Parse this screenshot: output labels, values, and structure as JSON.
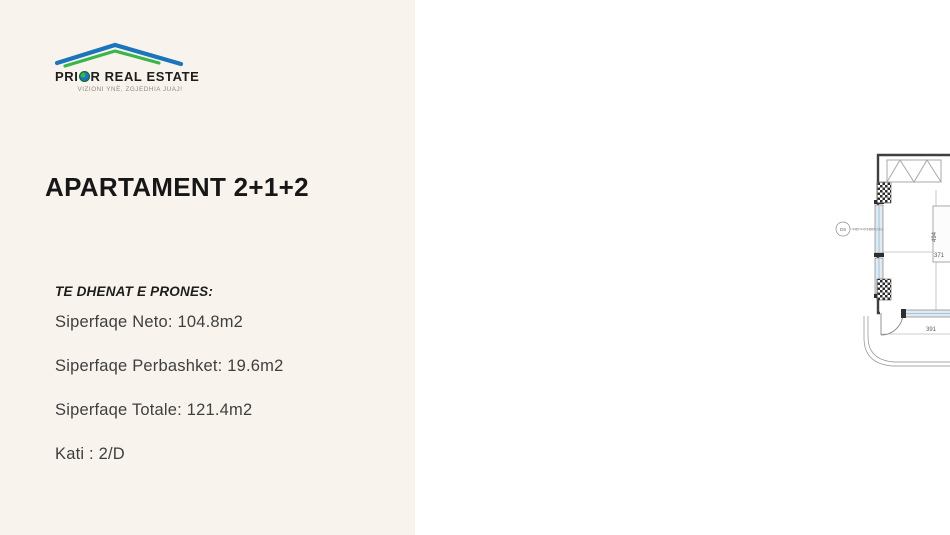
{
  "brand": {
    "name_left": "PRI",
    "name_right": "R REAL ESTATE",
    "tagline": "VIZIONI YNË, ZGJEDHIA JUAJ!"
  },
  "listing": {
    "title": "APARTAMENT 2+1+2",
    "details_heading": "TE DHENAT E PRONES:",
    "details": [
      "Siperfaqe Neto: 104.8m2",
      "Siperfaqe Perbashket: 19.6m2",
      "Siperfaqe Totale: 121.4m2",
      "Kati : 2/D"
    ]
  },
  "floor_plan": {
    "colors": {
      "fixtures": "#45b5e0",
      "entrance_arrow": "#e31e24",
      "walls": "#3f3f3f",
      "left_panel_bg": "#f8f4ed"
    },
    "dimensions": [
      {
        "t": "98",
        "x": 583,
        "y": 149,
        "v": false
      },
      {
        "t": "180",
        "x": 603,
        "y": 161,
        "v": true
      },
      {
        "t": "694",
        "x": 707,
        "y": 178,
        "v": false
      },
      {
        "t": "494",
        "x": 521,
        "y": 237,
        "v": true
      },
      {
        "t": "371",
        "x": 524,
        "y": 257,
        "v": false
      },
      {
        "t": "260",
        "x": 604,
        "y": 232,
        "v": true
      },
      {
        "t": "191",
        "x": 619,
        "y": 259,
        "v": false
      },
      {
        "t": "321",
        "x": 700,
        "y": 293,
        "v": false
      },
      {
        "t": "390",
        "x": 717,
        "y": 251,
        "v": true
      },
      {
        "t": "387",
        "x": 817,
        "y": 253,
        "v": true
      },
      {
        "t": "516",
        "x": 825,
        "y": 273,
        "v": true
      },
      {
        "t": "556",
        "x": 843,
        "y": 292,
        "v": false
      },
      {
        "t": "452",
        "x": 885,
        "y": 278,
        "v": true
      },
      {
        "t": "211",
        "x": 787,
        "y": 300,
        "v": false
      },
      {
        "t": "345",
        "x": 873,
        "y": 299,
        "v": false
      },
      {
        "t": "130",
        "x": 817,
        "y": 331,
        "v": true
      },
      {
        "t": "419",
        "x": 746,
        "y": 331,
        "v": false
      },
      {
        "t": "130",
        "x": 717,
        "y": 336,
        "v": true
      },
      {
        "t": "391",
        "x": 516,
        "y": 331,
        "v": false
      },
      {
        "t": "120",
        "x": 557,
        "y": 339,
        "v": true
      },
      {
        "t": "240",
        "x": 602,
        "y": 312,
        "v": true
      },
      {
        "t": "269",
        "x": 629,
        "y": 331,
        "v": false
      },
      {
        "t": "110",
        "x": 646,
        "y": 337,
        "v": true
      },
      {
        "t": "94",
        "x": 657,
        "y": 324,
        "v": false
      }
    ],
    "door_labels": [
      {
        "id": "D6",
        "spec": "HD = 0 180X240",
        "cx": 428,
        "cy": 229,
        "vertical": false
      },
      {
        "id": "D19",
        "spec": "HD = 0 200X240",
        "cx": 547,
        "cy": 351,
        "vertical": true
      },
      {
        "id": "D3",
        "spec": "HD =160 90X160",
        "cx": 631,
        "cy": 393,
        "vertical": true
      },
      {
        "id": "D6",
        "spec": "HD = 0 180X240",
        "cx": 713,
        "cy": 352,
        "vertical": true
      },
      {
        "id": "D20",
        "spec": "HD =90 100X140",
        "cx": 790,
        "cy": 351,
        "vertical": true
      },
      {
        "id": "D6",
        "spec": "HD = 0 180X240",
        "cx": 872,
        "cy": 391,
        "vertical": true
      }
    ]
  }
}
